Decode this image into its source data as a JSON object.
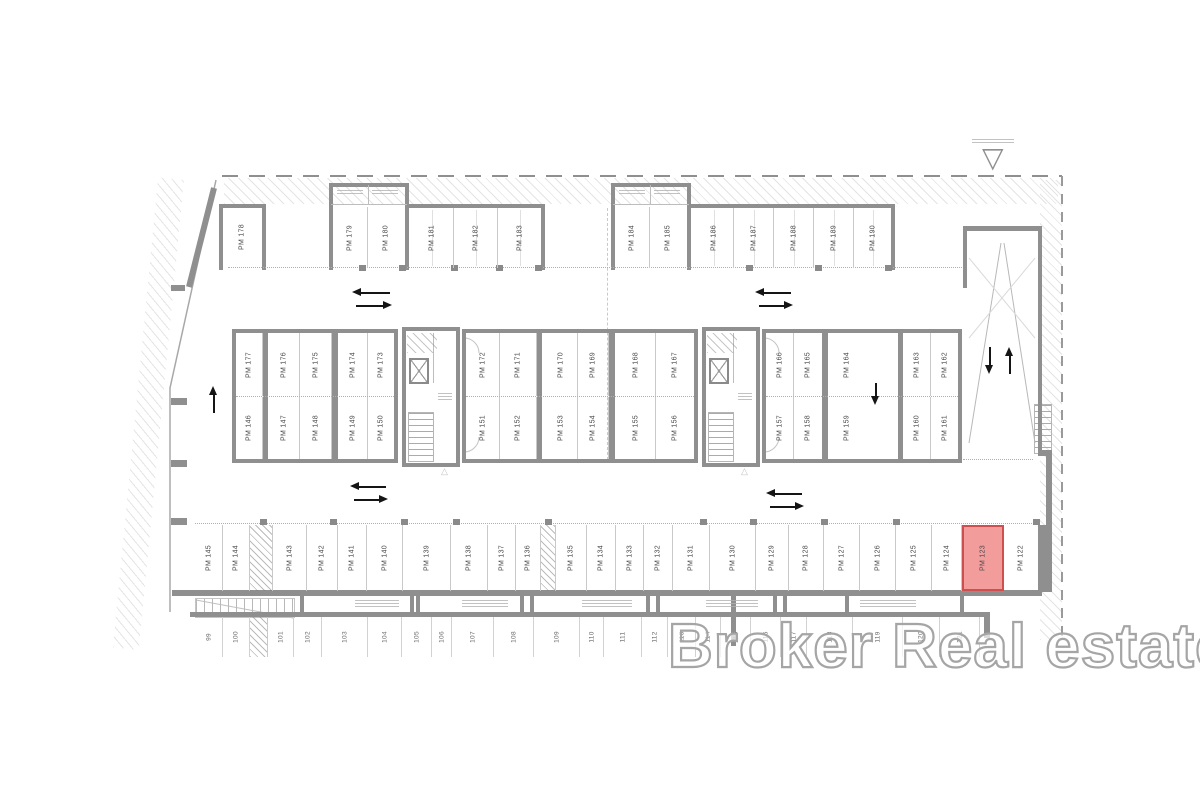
{
  "watermark": "Broker Real estate",
  "highlight": {
    "space": "PM 123",
    "fill": "#ec5f5f",
    "border": "#cf4f4f"
  },
  "colors": {
    "wall": "#8f8f8f",
    "thin_line": "#c9c9c9",
    "label": "#4a4a4a"
  },
  "groups": {
    "top_left_single": [
      "PM 178"
    ],
    "top_box1": [
      "PM 179",
      "PM 180"
    ],
    "top_bay1": [
      "PM 181",
      "PM 182",
      "PM 183"
    ],
    "top_box2": [
      "PM 184",
      "PM 185"
    ],
    "top_bay2": [
      "PM 186",
      "PM 187",
      "PM 188",
      "PM 189",
      "PM 190"
    ],
    "mid_upper_left": [
      "PM 177",
      "PM 176",
      "PM 175",
      "PM 174",
      "PM 173"
    ],
    "mid_lower_left": [
      "PM 146",
      "PM 147",
      "PM 148",
      "PM 149",
      "PM 150"
    ],
    "mid_upper_center": [
      "PM 172",
      "PM 171",
      "PM 170",
      "PM 169",
      "PM 168",
      "PM 167"
    ],
    "mid_lower_center": [
      "PM 151",
      "PM 152",
      "PM 153",
      "PM 154",
      "PM 155",
      "PM 156"
    ],
    "mid_upper_right_a": [
      "PM 166",
      "PM 165"
    ],
    "mid_lower_right_a": [
      "PM 157",
      "PM 158"
    ],
    "mid_upper_right_b": [
      "PM 164"
    ],
    "mid_lower_right_b": [
      "PM 159"
    ],
    "mid_upper_right_c": [
      "PM 163",
      "PM 162"
    ],
    "mid_lower_right_c": [
      "PM 160",
      "PM 161"
    ],
    "bottom_row": [
      "PM 145",
      "PM 144",
      "PM 143",
      "PM 142",
      "PM 141",
      "PM 140",
      "PM 139",
      "PM 138",
      "PM 137",
      "PM 136",
      "PM 135",
      "PM 134",
      "PM 133",
      "PM 132",
      "PM 131",
      "PM 130",
      "PM 129",
      "PM 128",
      "PM 127",
      "PM 126",
      "PM 125",
      "PM 124",
      "PM 123",
      "PM 122"
    ],
    "basement_row": [
      "99",
      "100",
      "101",
      "102",
      "103",
      "104",
      "105",
      "106",
      "107",
      "108",
      "109",
      "110",
      "111",
      "112",
      "113",
      "114",
      "115",
      "116",
      "117",
      "118",
      "119",
      "120",
      "121"
    ]
  }
}
